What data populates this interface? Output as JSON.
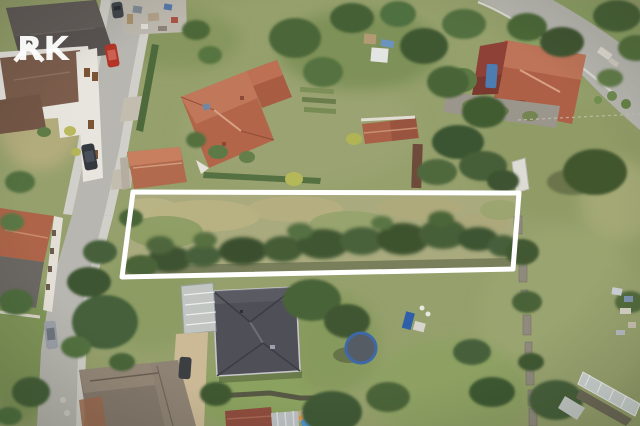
{
  "watermark": {
    "text": "RK"
  },
  "scene": {
    "type": "aerial-drone-photo",
    "subject": "residential neighborhood with highlighted land parcel for sale",
    "plot_outline_points": "133,192 519,193 513,269 122,277"
  },
  "colors": {
    "plot-outline": "#ffffff",
    "watermark": "#ffffff",
    "grass-base": "#95a06c",
    "road": "#b7b6b0",
    "sidewalk": "#d0cfc9",
    "plot-grass": "#a9aa7e",
    "roof-orange": "#b26549",
    "roof-dark": "#4f4f57",
    "roof-brown": "#7c5d4c",
    "tree-dark": "#41552f",
    "car-red": "#b23527",
    "pool-blue": "#4f93cc",
    "trampoline-blue": "#3e68a8"
  }
}
